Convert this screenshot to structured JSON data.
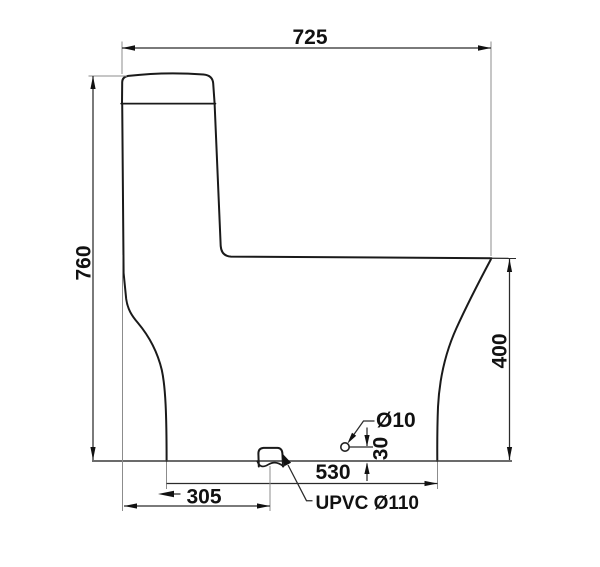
{
  "labels": {
    "width_top": "725",
    "height_left": "760",
    "height_right": "400",
    "base_length": "530",
    "outlet_offset": "305",
    "hole_height": "30",
    "hole_diameter": "Ø10",
    "outlet": "UPVC Ø110"
  },
  "colors": {
    "outline": "#1a1a1a",
    "dimension": "#2b2b2b",
    "extension": "#8c8c8c",
    "background": "#ffffff"
  }
}
